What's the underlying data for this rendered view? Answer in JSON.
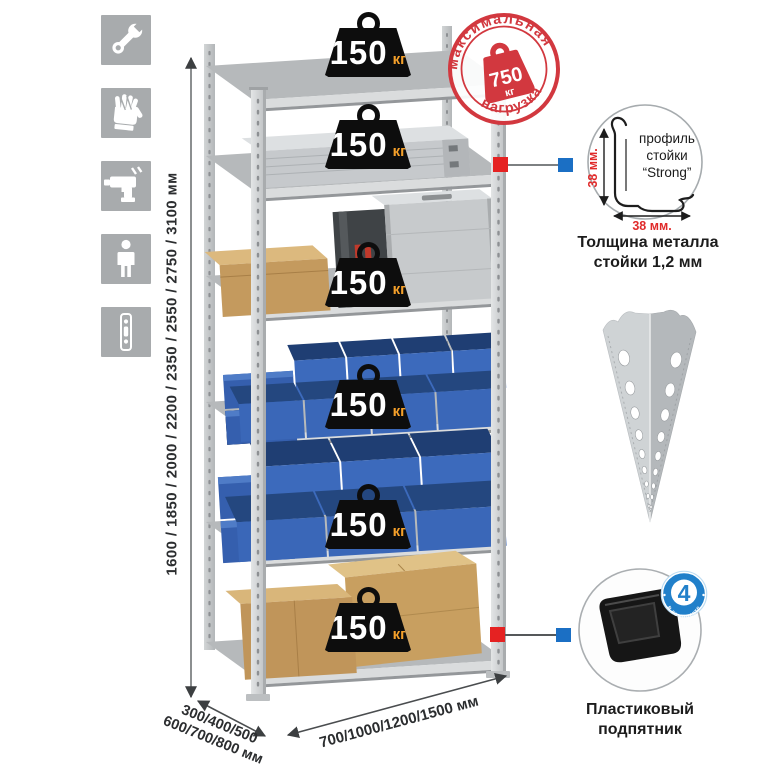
{
  "sidebar": {
    "icons": [
      {
        "name": "wrench-icon"
      },
      {
        "name": "gloves-icon"
      },
      {
        "name": "drill-icon"
      },
      {
        "name": "person-icon"
      },
      {
        "name": "upright-post-icon"
      }
    ]
  },
  "dimensions": {
    "height": "1600 / 1850 / 2000 / 2200 / 2350 / 2550 / 2750 / 3100 мм",
    "depth_line1": "300/400/500",
    "depth_line2": "600/700/800 мм",
    "width": "700/1000/1200/1500 мм"
  },
  "rack": {
    "shelf_count": 6,
    "badges": [
      {
        "value": "150",
        "unit": "кг"
      },
      {
        "value": "150",
        "unit": "кг"
      },
      {
        "value": "150",
        "unit": "кг"
      },
      {
        "value": "150",
        "unit": "кг"
      },
      {
        "value": "150",
        "unit": "кг"
      },
      {
        "value": "150",
        "unit": "кг"
      }
    ]
  },
  "stamp": {
    "arc_top": "максимальная",
    "arc_bottom": "нагрузка",
    "weight_value": "750",
    "weight_unit": "кг"
  },
  "profile_detail": {
    "label_line1": "профиль",
    "label_line2": "стойки",
    "label_line3": "“Strong”",
    "dim_vertical": "38 мм.",
    "dim_horizontal": "38 мм.",
    "caption_line1": "Толщина металла",
    "caption_line2": "стойки 1,2 мм"
  },
  "foot_detail": {
    "badge_value": "4",
    "badge_arc": "в комплекте",
    "caption_line1": "Пластиковый",
    "caption_line2": "подпятник"
  },
  "colors": {
    "stamp_red": "#d2383f",
    "connector_red": "#e52222",
    "connector_blue": "#1b6fc4",
    "bin_blue": "#3a67b8",
    "unit_orange": "#f5a02a",
    "metal_gray": "#c6c9cb",
    "tile_gray": "#a8abad",
    "dim_red": "#e02a2a"
  }
}
